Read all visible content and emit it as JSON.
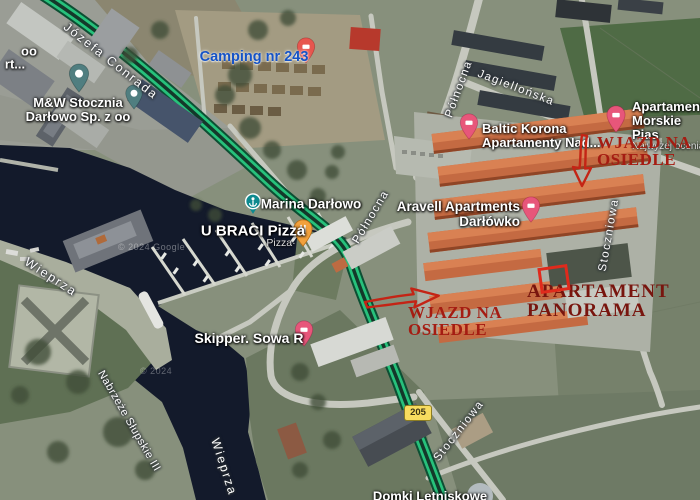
{
  "map": {
    "watermark_main": "© 2024 Google",
    "watermark_small": "© 2024",
    "road_shield": "205"
  },
  "streets": {
    "jozefa_conrada": "Józefa Conrada",
    "polnocna": "Północna",
    "jagiellonska": "Jagiellońska",
    "stoczniowa": "Stoczniowa",
    "wieprza": "Wieprza",
    "nabrzeze_slupskie": "Nabrzeże Słupskie III"
  },
  "pois": {
    "stocznia": {
      "line1": "M&W Stocznia",
      "line2": "Darłowo Sp. z oo"
    },
    "partial_port": {
      "line1": "oo",
      "line2": "rt..."
    },
    "camping": {
      "label": "Camping nr 243"
    },
    "marina": {
      "label": "Marina Darłowo"
    },
    "pizza": {
      "label": "U BRACI Pizza",
      "subtitle": "Pizza·"
    },
    "baltic_korona": {
      "line1": "Baltic Korona",
      "line2": "Apartamenty Nad..."
    },
    "aravell": {
      "line1": "Aravell Apartments",
      "line2": "Darłówko"
    },
    "morskie": {
      "line1": "Apartamenty",
      "line2": "Morskie Pias",
      "subtitle": "Najwyżej ocenia"
    },
    "skipper": {
      "label": "Skipper. Sowa R"
    },
    "domki": {
      "label": "Domki Letniskowe"
    }
  },
  "annotations": {
    "wjazd_top": {
      "line1": "WJAZD NA",
      "line2": "OSIEDLE"
    },
    "wjazd_mid": {
      "line1": "WJAZD NA",
      "line2": "OSIEDLE"
    },
    "panorama": {
      "line1": "APARTAMENT",
      "line2": "PANORAMA"
    }
  },
  "colors": {
    "route_green": "#27c17b",
    "annotation_red": "#a51c12",
    "panorama_red": "#78150e",
    "marker_red": "#e02a1c",
    "camping_blue": "#1553c6",
    "lodging_pin_pink": "#e7567a",
    "restaurant_pin_orange": "#f2a13d",
    "place_pin_teal": "#507e80",
    "marina_icon_teal": "#0e8a8f",
    "shield_yellow": "#f8dc5f",
    "water_dark": "#131a2b",
    "roof_orange": "#c46a42"
  }
}
